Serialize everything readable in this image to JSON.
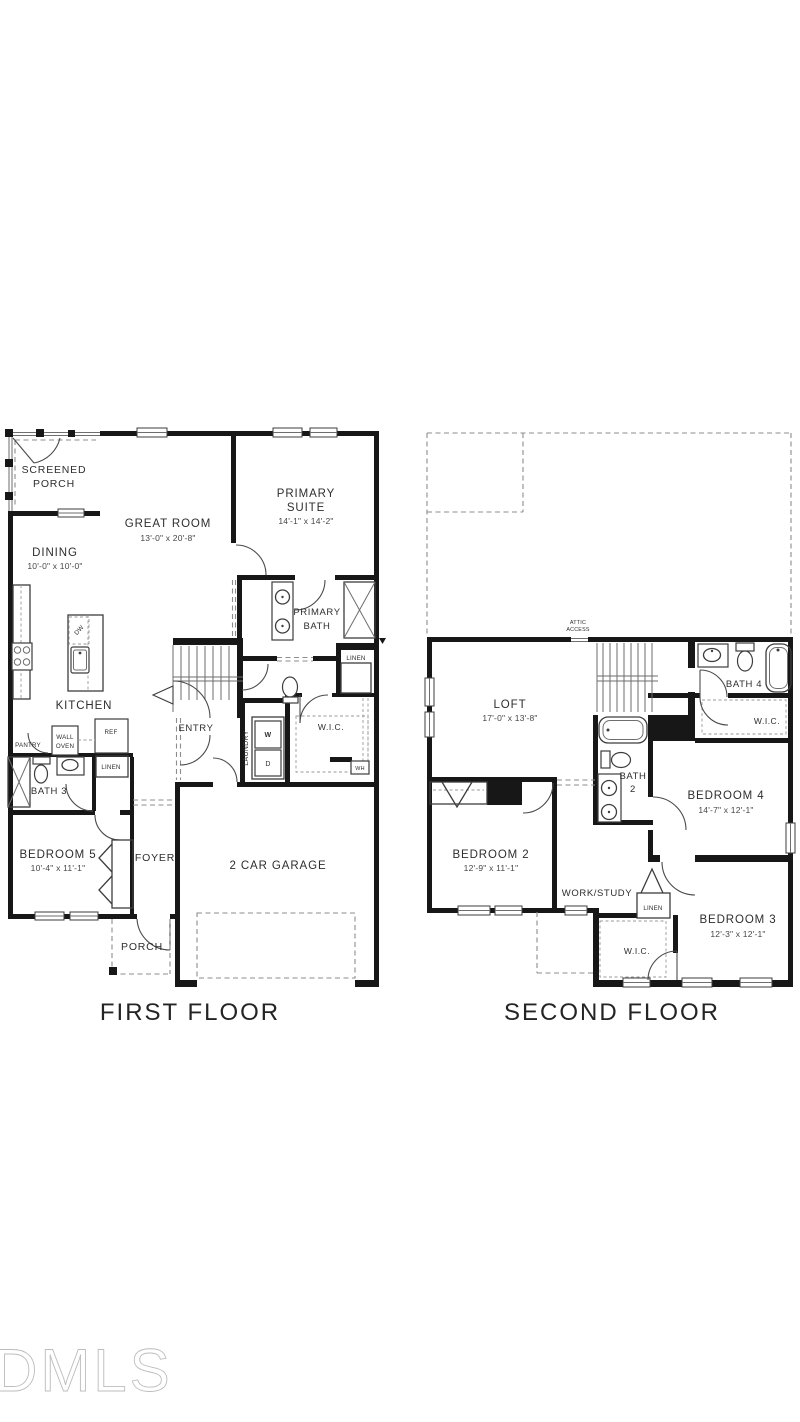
{
  "background": "#ffffff",
  "watermark": "DMLS",
  "colors": {
    "wall": "#171717",
    "thin_line": "#3d3d3d",
    "dashed_line": "#8c8c8c",
    "label_text": "#2e2e2e",
    "watermark": "#bdbdbd",
    "background": "#ffffff"
  },
  "first_floor": {
    "caption": "FIRST FLOOR",
    "rooms": {
      "screened_porch": {
        "line1": "SCREENED",
        "line2": "PORCH"
      },
      "dining": {
        "name": "DINING",
        "dims": "10'-0\" x 10'-0\""
      },
      "great_room": {
        "name": "GREAT ROOM",
        "dims": "13'-0\" x 20'-8\""
      },
      "primary_suite": {
        "line1": "PRIMARY",
        "line2": "SUITE",
        "dims": "14'-1\" x 14'-2\""
      },
      "primary_bath": {
        "line1": "PRIMARY",
        "line2": "BATH"
      },
      "linen_bath": "LINEN",
      "wic": "W.I.C.",
      "kitchen": "KITCHEN",
      "pantry": "PANTRY",
      "wall_oven": {
        "line1": "WALL",
        "line2": "OVEN"
      },
      "ref": "REF",
      "linen_hall": "LINEN",
      "bath3": "BATH 3",
      "bedroom5": {
        "name": "BEDROOM 5",
        "dims": "10'-4\" x 11'-1\""
      },
      "foyer": "FOYER",
      "entry": "ENTRY",
      "laundry": "LAUNDRY",
      "washer": "W",
      "dryer": "D",
      "water_heater": "WH",
      "dishwasher": "DW",
      "garage": "2 CAR GARAGE",
      "porch": "PORCH"
    }
  },
  "second_floor": {
    "caption": "SECOND FLOOR",
    "rooms": {
      "attic_access": {
        "line1": "ATTIC",
        "line2": "ACCESS"
      },
      "loft": {
        "name": "LOFT",
        "dims": "17'-0\" x 13'-8\""
      },
      "bath4": "BATH 4",
      "wic_bath": "W.I.C.",
      "bath2": {
        "line1": "BATH",
        "line2": "2"
      },
      "bedroom4": {
        "name": "BEDROOM 4",
        "dims": "14'-7\" x 12'-1\""
      },
      "bedroom2": {
        "name": "BEDROOM 2",
        "dims": "12'-9\" x 11'-1\""
      },
      "work_study": "WORK/STUDY",
      "linen": "LINEN",
      "bedroom3": {
        "name": "BEDROOM 3",
        "dims": "12'-3\" x 12'-1\""
      },
      "wic_bedroom3": "W.I.C."
    }
  }
}
